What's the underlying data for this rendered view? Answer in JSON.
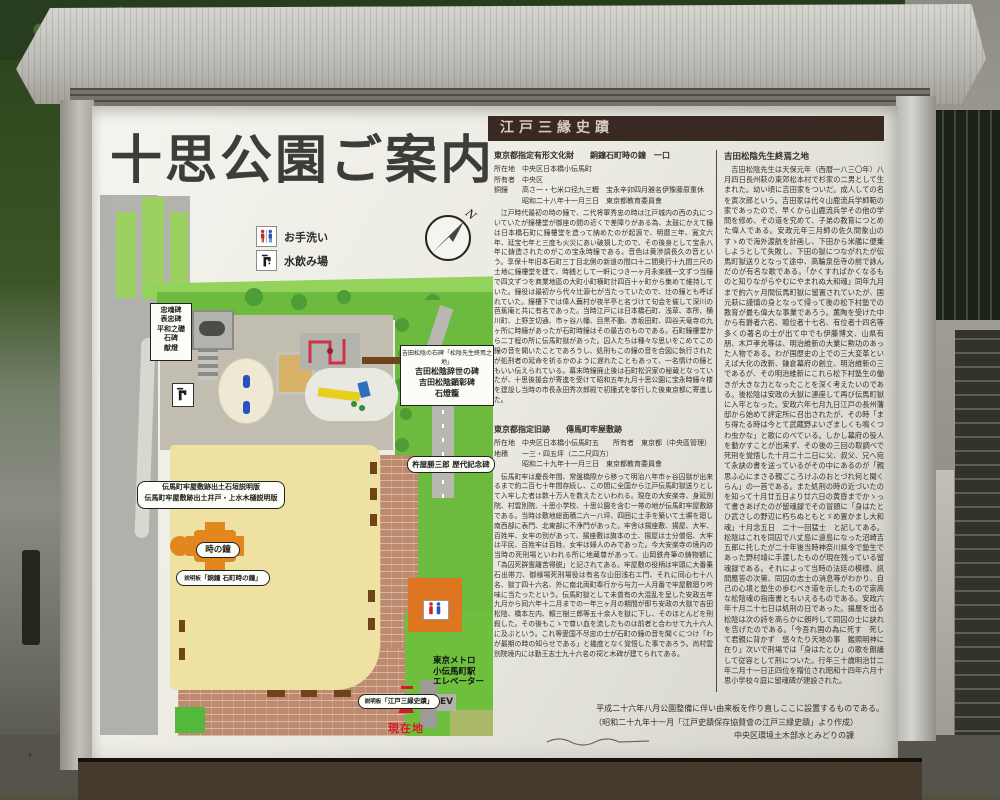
{
  "sign": {
    "title": "十思公園ご案内",
    "compass": "N",
    "legend": [
      {
        "icon": "toilet-icon",
        "label": "お手洗い"
      },
      {
        "icon": "fountain-icon",
        "label": "水飲み場"
      }
    ]
  },
  "map": {
    "labels": {
      "monuments": [
        "忠魂碑",
        "表忠碑",
        "平和之礎",
        "石碑",
        "献燈"
      ],
      "yoshida_small": "吉田松陰の石碑「松陰先生終焉之地」",
      "yoshida_lines": [
        "吉田松陰辞世の碑",
        "吉田松陰顕彰碑",
        "石燈籠"
      ],
      "denma_lines": [
        "伝馬町牢屋敷跡出土石垣説明版",
        "伝馬町牢屋敷跡出土井戸・上水木樋説明版"
      ],
      "tokinokane": "時の鐘",
      "dousho_prefix": "説明板",
      "dousho": "「銅鐘 石町時の鐘」",
      "kineya": "杵屋勝三郎 歴代記念碑",
      "edosanseki_prefix": "説明板",
      "edosanseki": "「江戸三縁史蹟」",
      "metro": [
        "東京メトロ",
        "小伝馬町駅",
        "エレベーター"
      ],
      "ev": "EV",
      "genzaichi": "現在地"
    }
  },
  "panels": {
    "header": "江戸三縁史蹟",
    "panel1": {
      "title": "東京都指定有形文化財　　銅鐘石町時の鐘　一口",
      "meta1": "所在地　中央区日本橋小伝馬町",
      "meta2": "所有者　中央区",
      "meta3": "銅鐘　　高さ一・七米口径九三糎　宝永辛卯四月雅名伊豫藤原重休",
      "meta4": "　　　　昭和二十八年十一月三日　東京都教育委員會",
      "body": "　江戸時代最初の時の鐘で、二代将軍秀忠の時は江戸城内の西の丸についていたが鐘樓堂が御座の間の近くで差障りがある為、太鼓にかえて鐘は日本橋石町に鐘樓堂を造って納めたのが起源で、明暦三年、寛文六年、延宝七年と三度も火災にあい破損したので、その後身として宝永八年に鋳造されたのがこの宝永時鐘である。音色は黄渉調長久の音という。享保十年旧本石町三丁目北側の新道の間口十二間奥行十九間三尺の土地に鐘樓堂を建て、時銭として一軒につき一ヶ月永楽銭一文ずつ当鐘で四文ずつを商業地區の大町小町横町計四百十ヶ町から集めて維持していた。鐘役は最初から代々辻源七が当たっていたので、辻の鐘とも呼ばれていた。鐘樓下では偉人蕪村が夜半亭と名づけて句会を催して深川の芭蕉庵と共に有名であった。当時江戸には日本橋石町、浅草、本所、横川町、上野芝切通、市ヶ谷八幡、目黒不動、赤坂田町、四谷天竜寺の九ヶ所に時鐘があったが石町時鐘はその最古のものである。石町鐘樓堂から二丁程の所に伝馬町獄があった。囚人たちは種々な思いをこめてこの鐘の音を聞いたことであろうし、処刑もこの鐘の音を合図に執行されたが処刑者の延命を祈るかのように遅れたこともあって、一名情けの鐘ともいい伝えられている。幕末時鐘廃止後は石町松沢家の秘蔵となっていたが、十思後援会が寄進を受けて昭和五年九月十思公園に宝永時鐘々楼を建設し当時の市長永田秀次郎殿で初撞式を挙行した後東京都に寄進した。"
    },
    "panel2": {
      "title": "東京都指定旧跡　　傳馬町牢屋敷跡",
      "meta1": "所在地　中央区日本橋小伝馬町五　　所有者　東京都（中央區管理）",
      "meta2": "地積　　一三・四五坪（二二尺四方）",
      "meta3": "　　　　昭和二十九年十一月三日　東京都教育委員會",
      "body": "　伝馬町牢は慶長年間、常盤橋際から移って明治八年市ヶ谷囚獄が出来るまで約二百七十年間存続し、この間に全国から江戸伝馬町獄送りとして入牢した者は数十万人を数えたといわれる。現在の大安楽寺、身延別院、村雲別院、十思小学校、十思公園を含む一帯の地が伝馬町牢屋敷跡である。当時は敷地総面積二六一八坪、四囲に土手を築いて土塀を廻し南西部に表門、北東部に不浄門があった。牢舎は揚座敷、揚屋、大牢、百姓牢、女牢の別があって、揚座敷は旗本の士、揚屋は士分僧侶、大牢は平民、百姓牢は百姓、女牢は婦人のみであった。今大安楽寺の境内の当時の死刑場といわれる所に地蔵尊があって、山岡鉄舟筆の鋳物額に「為囚死群霊離苦得脱」と記されてある。牢屋敷の役柄は牢頭に大番乗石出帯刀、御様場死刑場役は有名な山田浅右エ門、それに同心七十八名、獄丁四十六名、外に南北両町奉行から与力一人月番で牢屋敷廻り吟味に当たったという。伝馬町獄として未曾有の大混乱を呈した安政五年九月から同六年十二月までの一年三ヶ月の期間が即ち安政の大獄で吉田松陰、橋本左内、頼三樹三郎等五十余人を獄に下し、そのほとんどを刑殺した。その後もこゝで尊い血を流したものは前者と合わせて九十六人に及ぶという。これ等愛国不尽忠の士が石町の鐘の音を聞くにつけ「わが最期の時の知らせである」と幾度となく覚悟した事であろう。尚村雲別院境内には勤王志士九十六名の祠と木碑が建てられてある。"
    },
    "panel3": {
      "title": "吉田松陰先生終焉之地",
      "body": "　吉田松陰先生は天保元年（西暦一八三〇年）八月四日長州萩の東郊松本村で杉家の二男として生まれた。幼い頃に吉田家をついだ。成人しての名を寅次郎という。吉田家は代々山鹿流兵学師範の家であったので、早くから山鹿流兵学その他の学問を修め、その道を究めて、子弟の教育につとめた偉人である。安政元年三月師の佐久間象山のすゝめで海外渡航を計画し、下田から米艦に便乗しようとして失敗し、下田の獄につながれたが伝馬町獄送りとなって途中、高輪泉岳寺の前で詠んだのが有名な歌である。「かくすればかくなるものと知りながらやむにやまれぬ大和魂」同年九月まで約六ヶ月間伝馬町獄に留置されていたが、国元萩に謹慎の身となって帰って後の松下村塾での教育が最も偉大な事業であろう。薫陶を受けた中から有爵者六名、贈位者十七名、有位者十四名等多くの著名の士が出て中でも伊藤博文、山県有朋、木戸孝允等は、明治維新の大業に勲功のあった人物である。わが国歴史の上での三大変革といえば大化の改新、鎌倉幕府の創立、明治維新の三であるが、その明治維新にこれら松下村塾生の働きが大きな力となったことを深く考えたいのである。後松陰は安政の大獄に連座して再び伝馬町獄に入牢となった。安政六年七月九日江戸の長州藩邸から始めて評定所に召出されたが、その時「まち得たる時は今とて武蔵野よいざましくも鳴くつわ虫かな」と歌にのべている。しかし幕府の役人を動かすことが出来ず、その後の三回の取調べで死刑を覚悟した十月二十二日に父、叔父、兄へ宛て永訣の書を送っているがその中にあるのが「親思ふ心にまさる親ごころけふのおとづれ何と聞くらん」の一首である。また処刑の時の近づいたのを知って十月廿五日より廿六日の黄昏までかゝって書きあげたのが留魂録でその冒頭に「身はたとひ武さしの野辺に朽ちぬともとゞめ置かまし大和魂」十月念五日　二十一回猛士　と記してある。松陰はこれを同囚で八丈島に遠島になった沼崎吉五郎に托したが二十年後当時神奈川県令で塾生であった野村靖に手渡したものが現在残っている留魂録である。それによって当時の法廷の模様、訊問應答の次第、同囚の志士の消息等がわかり、自己の心境と塾生の歩むべき道を示したもので崇高な松陰魂の指南書ともいえるものである。安政六年十月二十七日は処刑の日であった。揚屋を出る松陰は次の詩を高らかに朗吟して同囚の士に訣れを告げたのである。「今吾れ国の為に死す　死して君親に背かず　悠々たり天地の事　鑑照明神に在り」次いで刑場では「身はたとひ」の歌を朗誦して従容として刑についた。行年三十歳明治廿二年二月十一日正四位を贈位され昭和十四年六月十思小学校々庭に留魂碑が建設された。"
    },
    "footer": [
      "平成二十六年八月公園整備に伴い由来板を作り直しここに設置するものである。",
      "（昭和二十九年十一月「江戸史蹟保存協賛會の江戸三縁史蹟」より作成）",
      "中央区環境土木部水とみどりの課"
    ]
  },
  "colors": {
    "header_band": "#3a2822",
    "map_green": "#6cbb3e",
    "map_plaza": "#eee1a1",
    "map_brick": "#bd8a6e",
    "bell_orange": "#e2861e",
    "current_location_red": "#d51c24"
  }
}
